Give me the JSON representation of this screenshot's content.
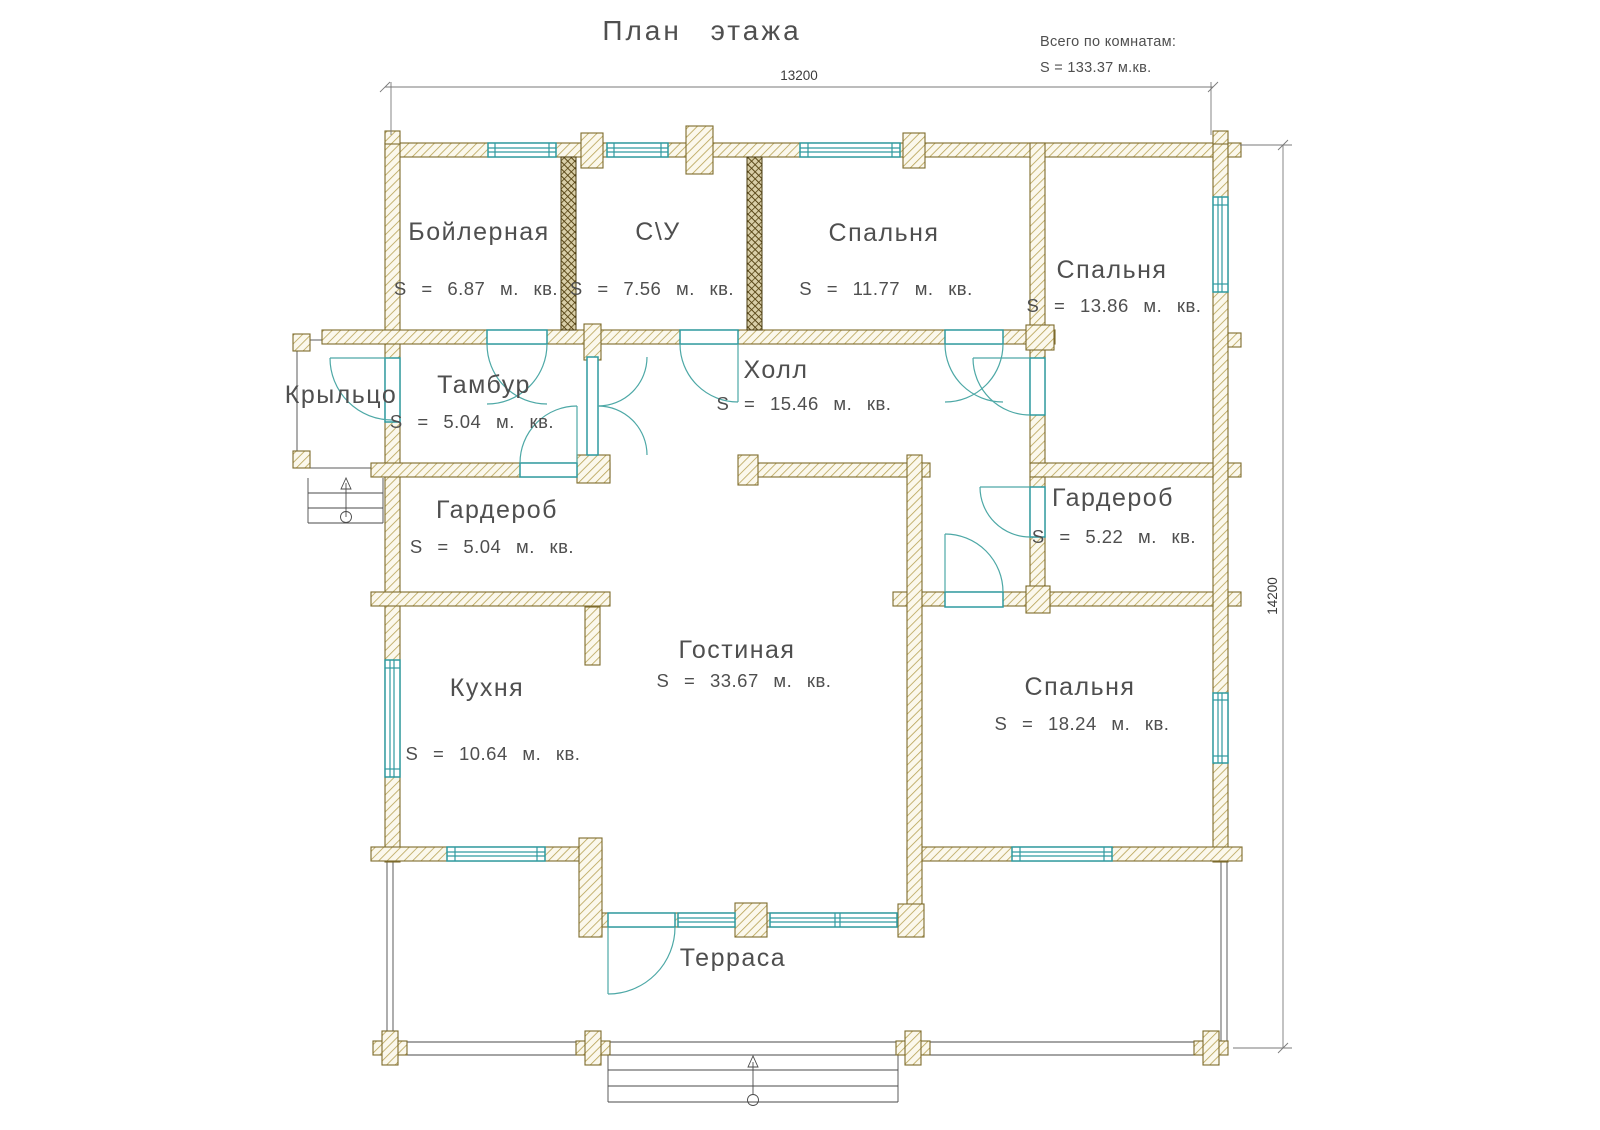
{
  "title": "План этажа",
  "summary": {
    "line1": "Всего по комнатам:",
    "line2": "S = 133.37 м.кв."
  },
  "dimensions": {
    "width_mm": "13200",
    "height_mm": "14200"
  },
  "rooms": {
    "boiler": {
      "name": "Бойлерная",
      "area": "S = 6.87 м. кв."
    },
    "wc": {
      "name": "С\\У",
      "area": "S = 7.56 м. кв."
    },
    "bedroomTM": {
      "name": "Спальня",
      "area": "S = 11.77 м. кв."
    },
    "bedroomTR": {
      "name": "Спальня",
      "area": "S = 13.86 м. кв."
    },
    "porch": {
      "name": "Крыльцо"
    },
    "tambour": {
      "name": "Тамбур",
      "area": "S = 5.04 м. кв."
    },
    "hall": {
      "name": "Холл",
      "area": "S = 15.46 м. кв."
    },
    "wardrobeL": {
      "name": "Гардероб",
      "area": "S = 5.04 м. кв."
    },
    "wardrobeR": {
      "name": "Гардероб",
      "area": "S = 5.22 м. кв."
    },
    "kitchen": {
      "name": "Кухня",
      "area": "S = 10.64 м. кв."
    },
    "living": {
      "name": "Гостиная",
      "area": "S = 33.67 м. кв."
    },
    "bedroomBR": {
      "name": "Спальня",
      "area": "S = 18.24 м. кв."
    },
    "terrace": {
      "name": "Терраса"
    }
  },
  "colors": {
    "wall_hatch": "#b7a254",
    "wall_outline": "#7d6b2c",
    "dark_partition": "#564414",
    "joinery_teal": "#2f9aa0",
    "text": "#4f4f4f"
  }
}
